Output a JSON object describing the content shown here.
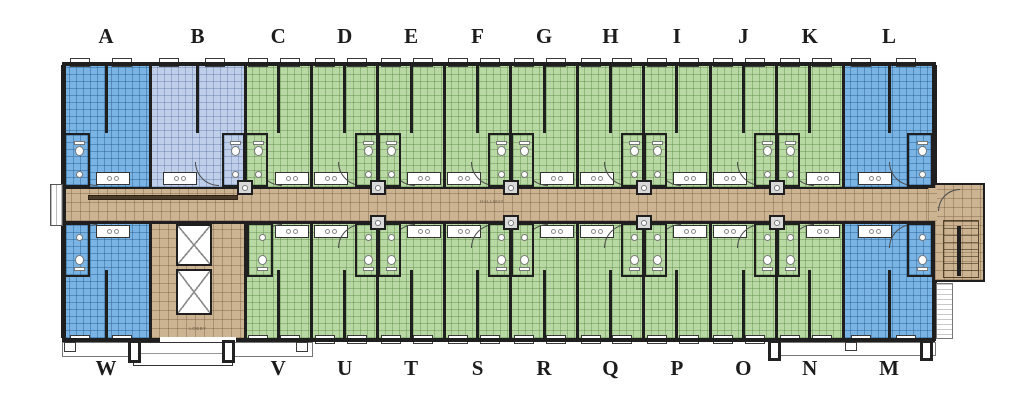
{
  "canvas": {
    "background": "#ffffff"
  },
  "hallway_label": "HALLWAY",
  "units": {
    "top": [
      {
        "label": "A",
        "fill": "blue"
      },
      {
        "label": "B",
        "fill": "light-blue"
      },
      {
        "label": "C",
        "fill": "green"
      },
      {
        "label": "D",
        "fill": "green"
      },
      {
        "label": "E",
        "fill": "green"
      },
      {
        "label": "F",
        "fill": "green"
      },
      {
        "label": "G",
        "fill": "green"
      },
      {
        "label": "H",
        "fill": "green"
      },
      {
        "label": "I",
        "fill": "green"
      },
      {
        "label": "J",
        "fill": "green"
      },
      {
        "label": "K",
        "fill": "green"
      },
      {
        "label": "L",
        "fill": "blue"
      }
    ],
    "bottom": [
      {
        "label": "W",
        "fill": "blue"
      },
      {
        "label": "LOBBY",
        "fill": "tan",
        "lobby": true
      },
      {
        "label": "V",
        "fill": "green"
      },
      {
        "label": "U",
        "fill": "green"
      },
      {
        "label": "T",
        "fill": "green"
      },
      {
        "label": "S",
        "fill": "green"
      },
      {
        "label": "R",
        "fill": "green"
      },
      {
        "label": "Q",
        "fill": "green"
      },
      {
        "label": "P",
        "fill": "green"
      },
      {
        "label": "O",
        "fill": "green"
      },
      {
        "label": "N",
        "fill": "green"
      },
      {
        "label": "M",
        "fill": "blue"
      }
    ]
  },
  "colors": {
    "unit_blue": "#79b4e5",
    "unit_green": "#b9d9a4",
    "unit_light_blue": "#bfcfe9",
    "corridor_tan": "#ccb493",
    "wall": "#1f1f1f",
    "label_text": "#1c1c1c"
  },
  "features": {
    "elevator_shafts": 2,
    "stairwell_position": "right-end",
    "entrance_porch_position": "bottom-left",
    "second_porch_position": "bottom-right"
  }
}
